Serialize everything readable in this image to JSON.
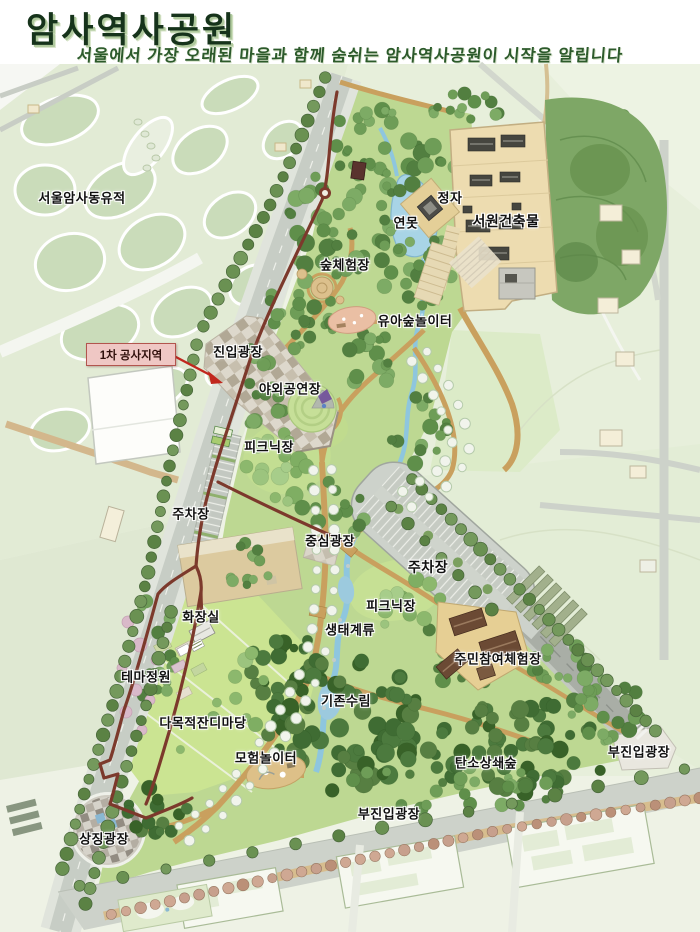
{
  "header": {
    "title": "암사역사공원",
    "subtitle": "서울에서 가장 오래된 마을과 함께 숨쉬는 암사역사공원이 시작을 알립니다"
  },
  "annotation": {
    "construction_area": "1차 공사지역"
  },
  "map": {
    "labels": [
      {
        "id": "seoul-amsadong-site",
        "text": "서울암사동유적"
      },
      {
        "id": "pavilion",
        "text": "정자"
      },
      {
        "id": "pond",
        "text": "연못"
      },
      {
        "id": "seowon-buildings",
        "text": "서원건축물"
      },
      {
        "id": "forest-experience",
        "text": "숲체험장"
      },
      {
        "id": "toddler-forest-playground",
        "text": "유아숲놀이터"
      },
      {
        "id": "entry-plaza",
        "text": "진입광장"
      },
      {
        "id": "outdoor-stage",
        "text": "야외공연장"
      },
      {
        "id": "picnic-area-west",
        "text": "피크닉장"
      },
      {
        "id": "parking-west",
        "text": "주차장"
      },
      {
        "id": "central-plaza",
        "text": "중심광장"
      },
      {
        "id": "parking-east",
        "text": "주차장"
      },
      {
        "id": "picnic-area-east",
        "text": "피크닉장"
      },
      {
        "id": "eco-stream",
        "text": "생태계류"
      },
      {
        "id": "resident-experience",
        "text": "주민참여체험장"
      },
      {
        "id": "restroom",
        "text": "화장실"
      },
      {
        "id": "theme-garden",
        "text": "테마정원"
      },
      {
        "id": "existing-forest",
        "text": "기존수림"
      },
      {
        "id": "multipurpose-lawn",
        "text": "다목적잔디마당"
      },
      {
        "id": "adventure-playground",
        "text": "모험놀이터"
      },
      {
        "id": "carbon-offset-forest",
        "text": "탄소상쇄숲"
      },
      {
        "id": "sub-entry-plaza-east",
        "text": "부진입광장"
      },
      {
        "id": "sub-entry-plaza-south",
        "text": "부진입광장"
      },
      {
        "id": "symbol-plaza",
        "text": "상징광장"
      }
    ],
    "colors": {
      "title_green": "#16331b",
      "park_lawn": "#bdd892",
      "dense_forest": "#3f6c33",
      "water": "#a8d4e6",
      "trail_maroon": "#7c392c",
      "construction_pink": "#efc7c4",
      "construction_red": "#c1271e",
      "seowon_tan": "#eddcb0"
    }
  }
}
